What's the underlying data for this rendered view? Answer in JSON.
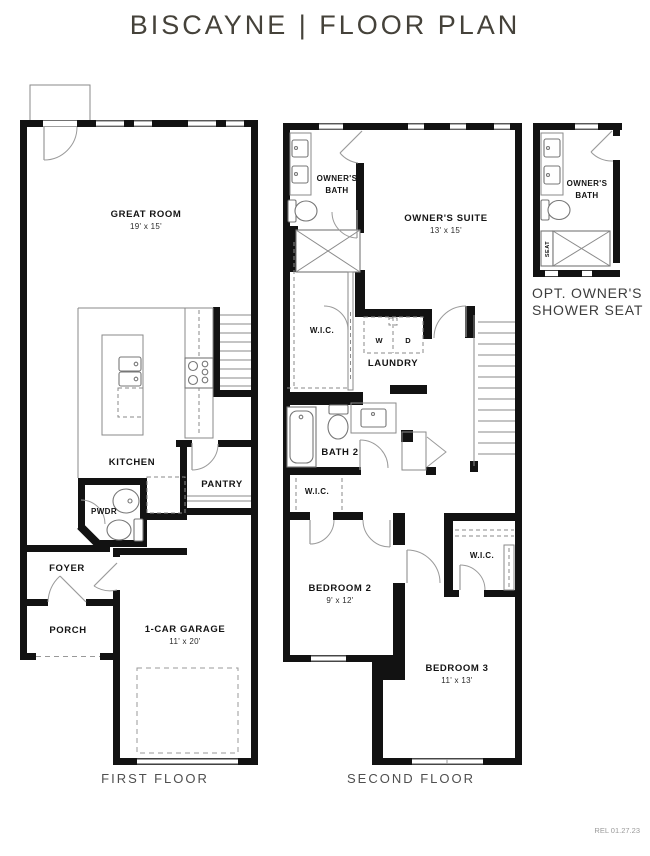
{
  "title": "BISCAYNE | FLOOR PLAN",
  "release": "REL 01.27.23",
  "first_floor": {
    "caption": "FIRST FLOOR",
    "rooms": {
      "great_room": {
        "name": "GREAT ROOM",
        "dims": "19' x 15'"
      },
      "kitchen": {
        "name": "KITCHEN"
      },
      "pantry": {
        "name": "PANTRY"
      },
      "powder": {
        "name": "PWDR"
      },
      "foyer": {
        "name": "FOYER"
      },
      "porch": {
        "name": "PORCH"
      },
      "garage": {
        "name": "1-CAR GARAGE",
        "dims": "11' x 20'"
      }
    }
  },
  "second_floor": {
    "caption": "SECOND FLOOR",
    "rooms": {
      "owners_bath": {
        "name_line1": "OWNER'S",
        "name_line2": "BATH"
      },
      "owners_suite": {
        "name": "OWNER'S SUITE",
        "dims": "13' x 15'"
      },
      "wic1": {
        "name": "W.I.C."
      },
      "laundry": {
        "name": "LAUNDRY",
        "washer": "W",
        "dryer": "D"
      },
      "bath2": {
        "name": "BATH 2"
      },
      "wic2": {
        "name": "W.I.C."
      },
      "bedroom2": {
        "name": "BEDROOM 2",
        "dims": "9' x 12'"
      },
      "wic3": {
        "name": "W.I.C."
      },
      "bedroom3": {
        "name": "BEDROOM 3",
        "dims": "11' x 13'"
      }
    }
  },
  "option_detail": {
    "caption_line1": "OPT. OWNER'S",
    "caption_line2": "SHOWER SEAT",
    "owners_bath": {
      "name_line1": "OWNER'S",
      "name_line2": "BATH"
    },
    "seat": "SEAT"
  }
}
